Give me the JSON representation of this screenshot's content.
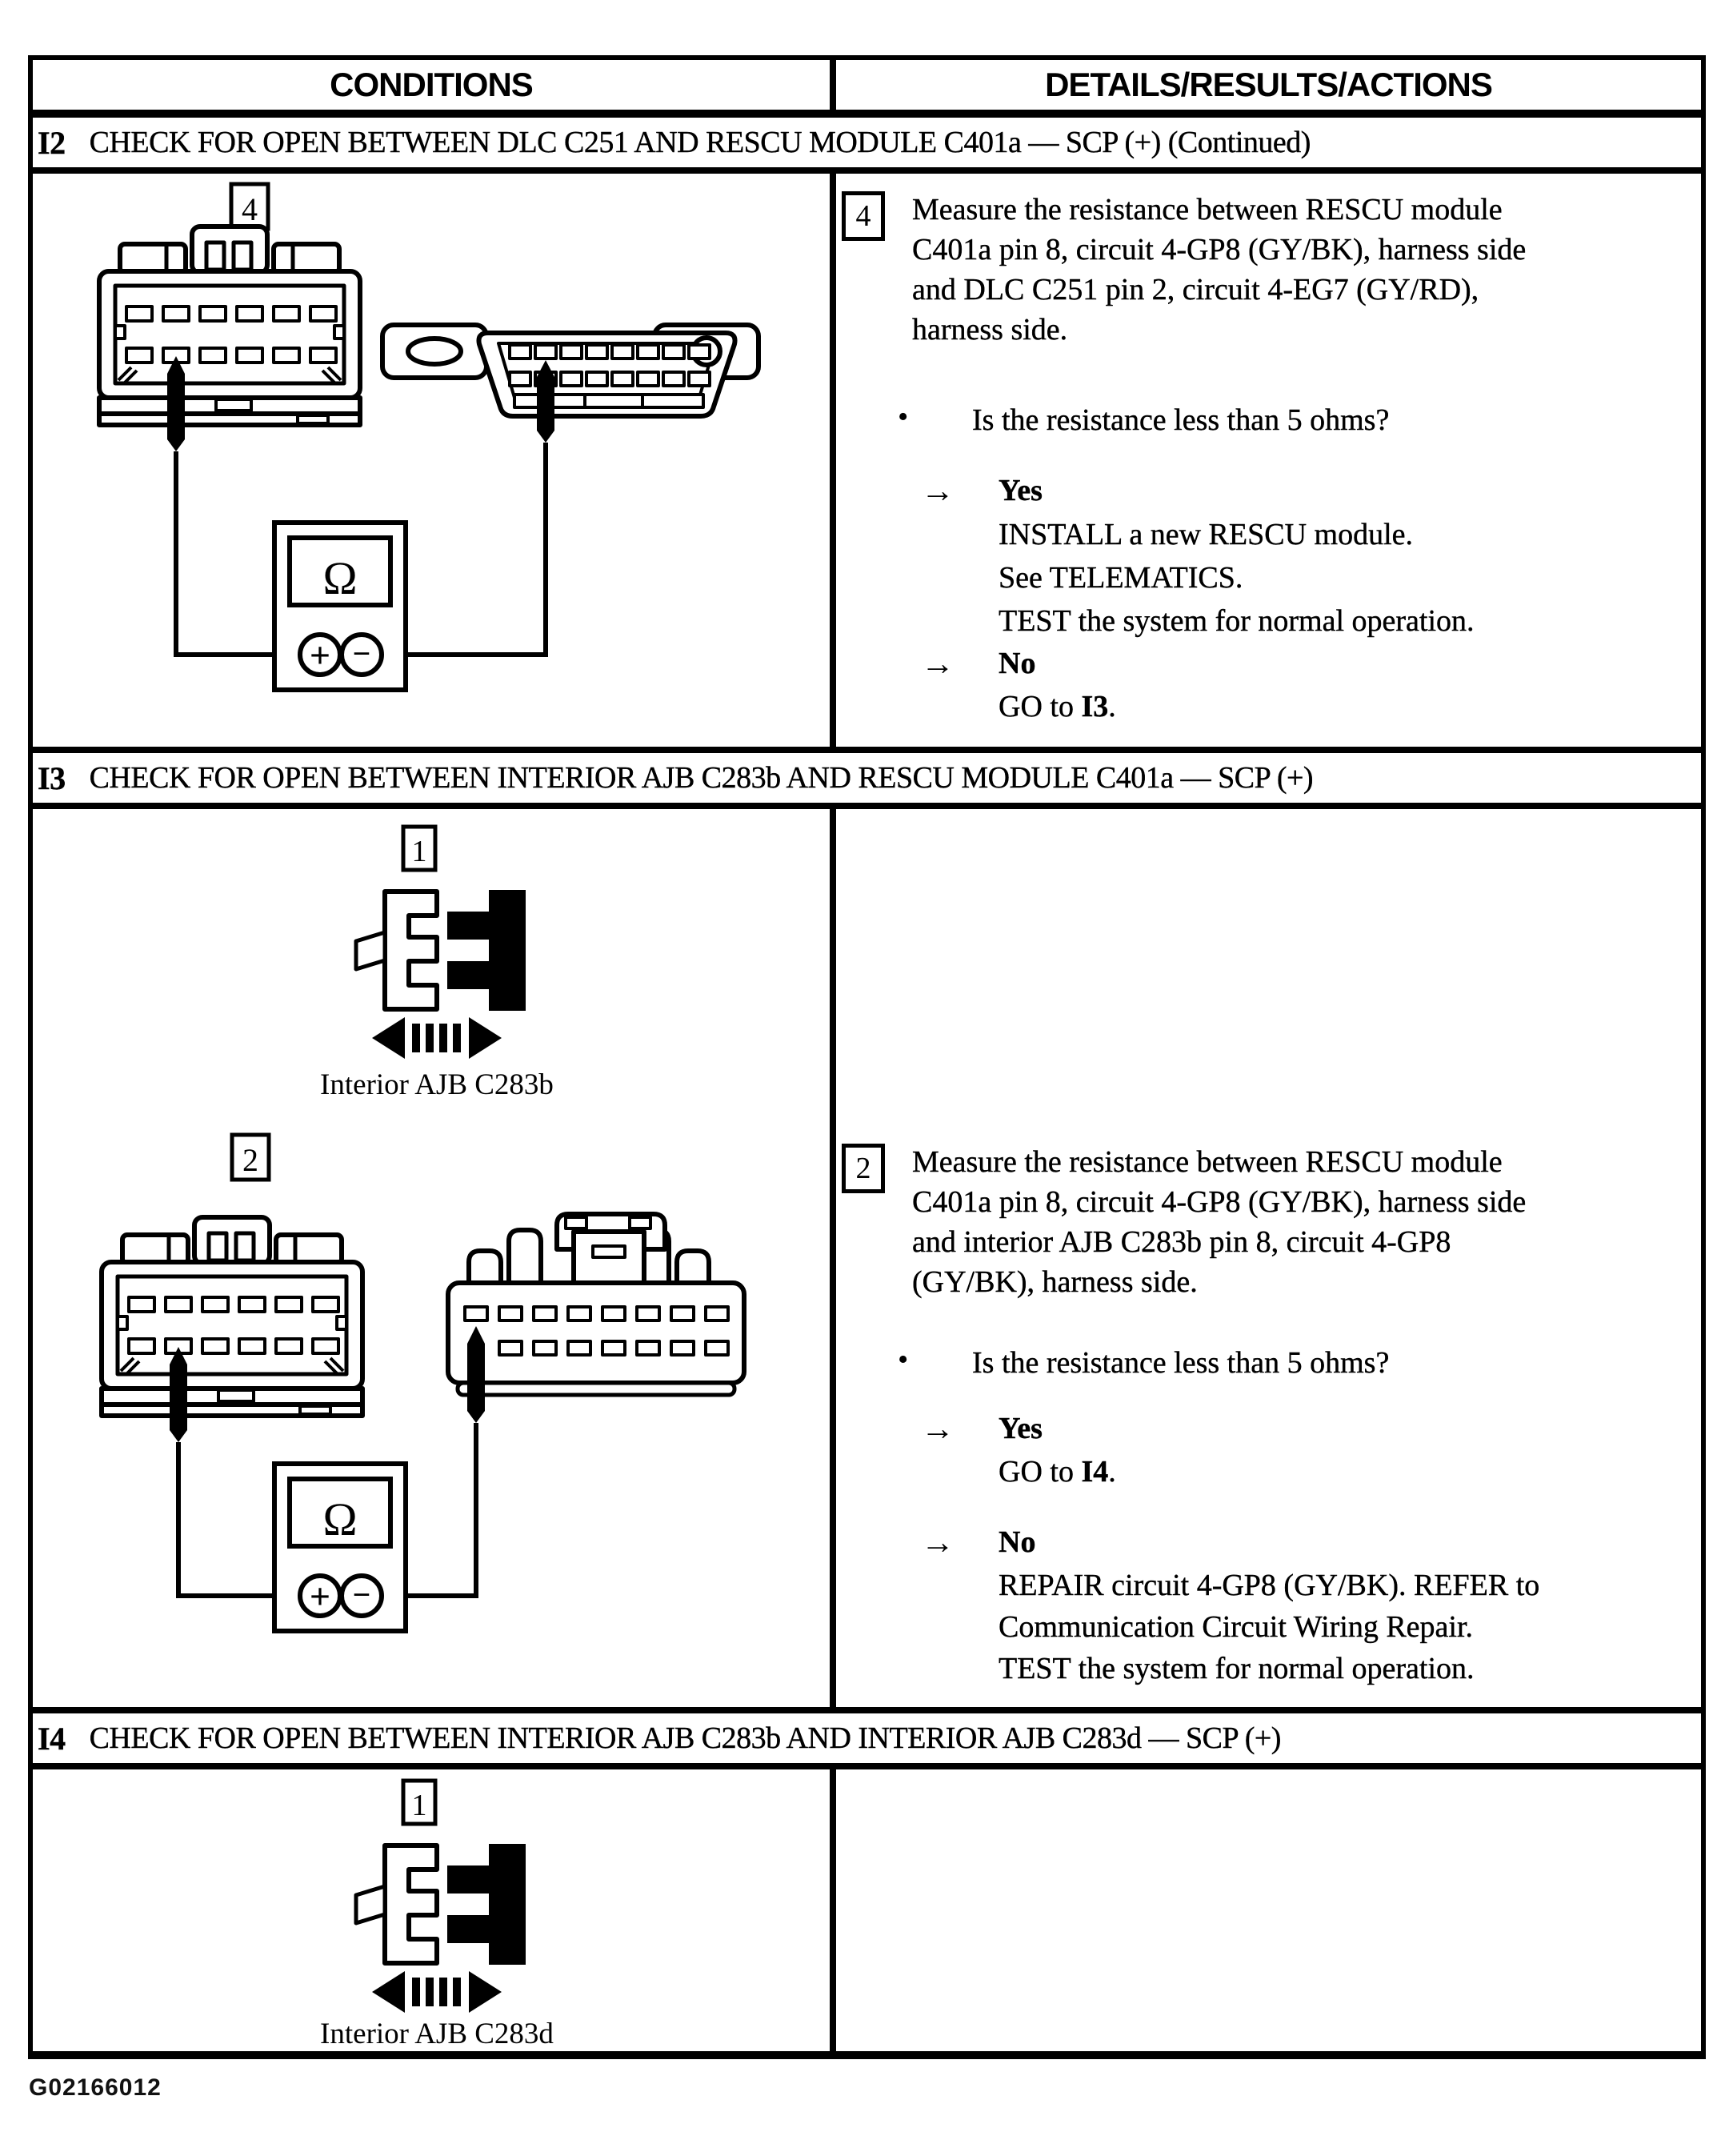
{
  "figure_code": "G02166012",
  "glyphs": {
    "arrow": "→",
    "bullet": "•"
  },
  "meter": {
    "display": "Ω",
    "plus": "+",
    "minus": "−"
  },
  "header": {
    "conditions": "CONDITIONS",
    "details": "DETAILS/RESULTS/ACTIONS"
  },
  "i2": {
    "id": "I2",
    "title": "CHECK FOR OPEN BETWEEN DLC C251 AND RESCU MODULE C401a — SCP (+) (Continued)",
    "step": "4",
    "measure_lines": [
      "Measure the resistance between RESCU module",
      "C401a pin 8, circuit 4-GP8 (GY/BK), harness side",
      "and DLC C251 pin 2, circuit 4-EG7 (GY/RD),",
      "harness side."
    ],
    "question": "Is the resistance less than 5 ohms?",
    "yes_label": "Yes",
    "yes_lines": [
      "INSTALL a new RESCU module.",
      "See TELEMATICS.",
      "TEST the system for normal operation."
    ],
    "no_label": "No",
    "no_goto_prefix": "GO to ",
    "no_goto_target": "I3",
    "no_goto_suffix": "."
  },
  "i3": {
    "id": "I3",
    "title": "CHECK FOR OPEN BETWEEN INTERIOR AJB C283b AND RESCU MODULE C401a — SCP (+)",
    "step1": "1",
    "connector_label": "Interior AJB C283b",
    "step2": "2",
    "measure_lines": [
      "Measure the resistance between RESCU module",
      "C401a pin 8, circuit 4-GP8 (GY/BK), harness side",
      "and interior AJB C283b pin 8, circuit 4-GP8",
      "(GY/BK), harness side."
    ],
    "question": "Is the resistance less than 5 ohms?",
    "yes_label": "Yes",
    "yes_goto_prefix": "GO to ",
    "yes_goto_target": "I4",
    "yes_goto_suffix": ".",
    "no_label": "No",
    "no_lines": [
      "REPAIR circuit 4-GP8 (GY/BK). REFER to",
      "Communication Circuit Wiring Repair.",
      "TEST the system for normal operation."
    ]
  },
  "i4": {
    "id": "I4",
    "title": "CHECK FOR OPEN BETWEEN INTERIOR AJB C283b AND INTERIOR AJB C283d — SCP (+)",
    "step1": "1",
    "connector_label": "Interior AJB C283d"
  }
}
